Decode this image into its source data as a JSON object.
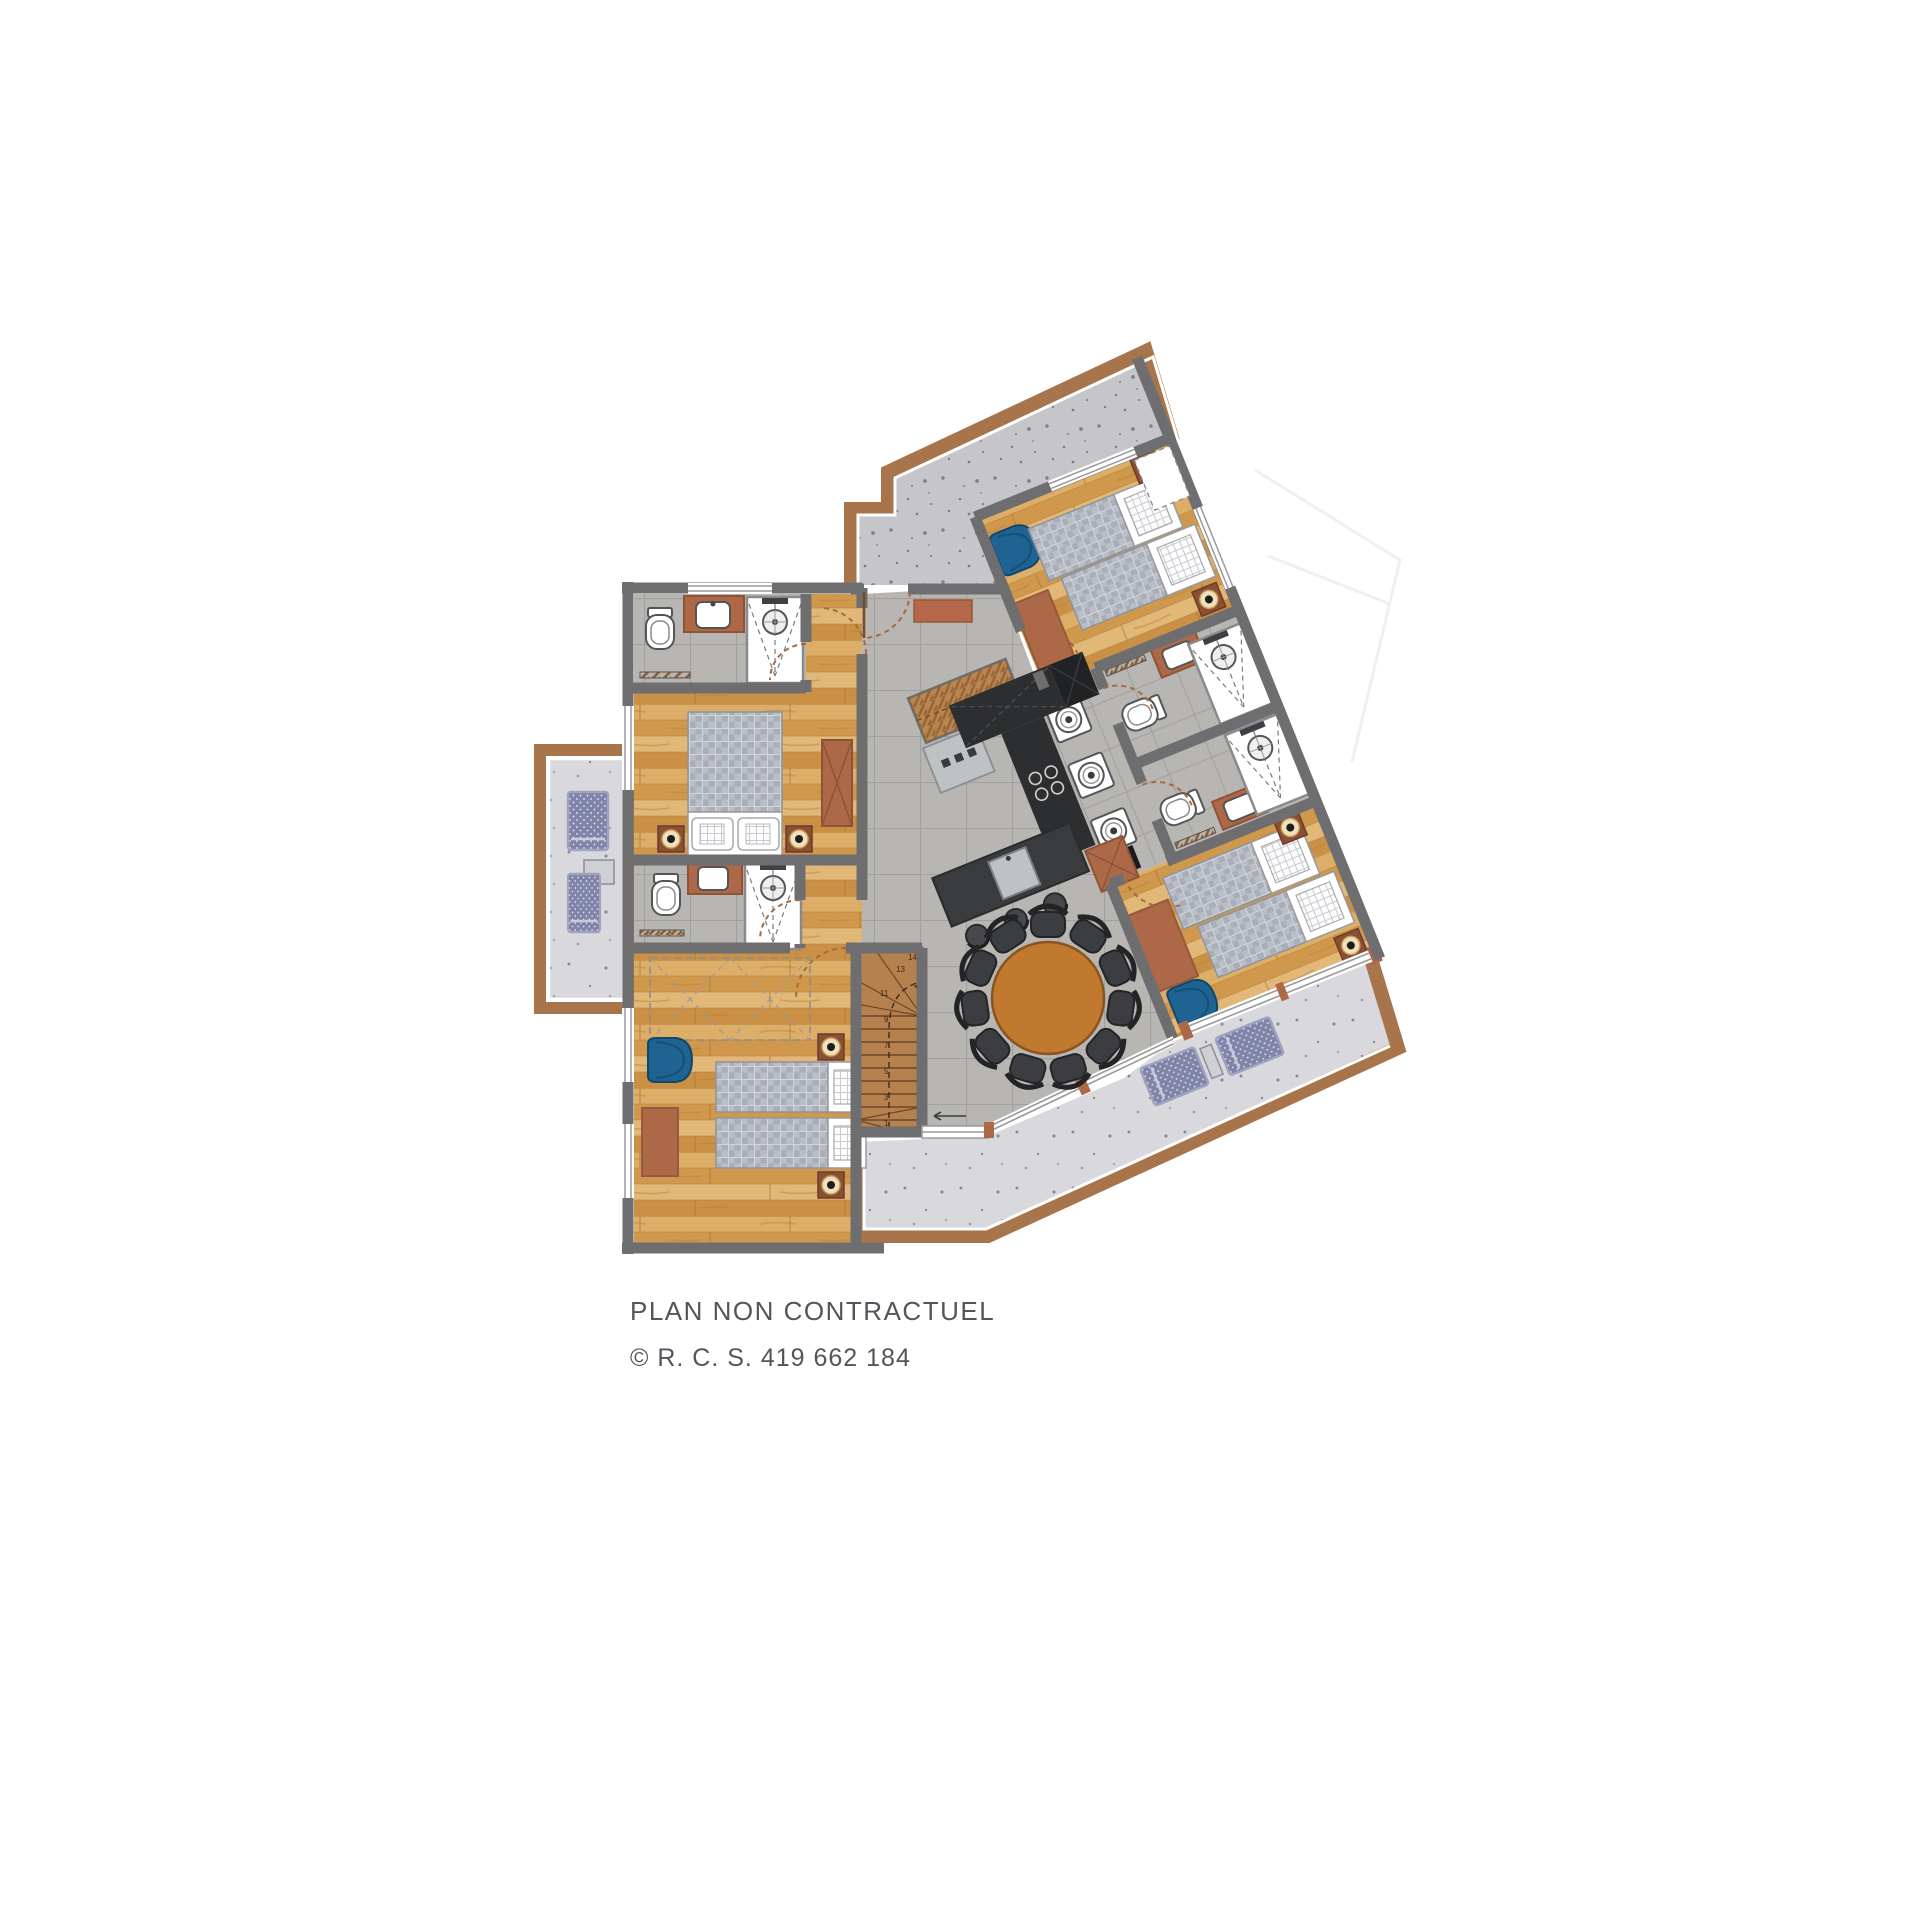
{
  "footer": {
    "disclaimer": "PLAN NON CONTRACTUEL",
    "registration": "© R. C. S. 419 662 184"
  },
  "stairs": {
    "steps": [
      "1",
      "2",
      "3",
      "4",
      "5",
      "6",
      "7",
      "8",
      "9",
      "10",
      "11",
      "12",
      "13",
      "14"
    ]
  },
  "plan": {
    "rotation_deg": -22,
    "rooms": [
      "terrace-top",
      "terrace-left",
      "terrace-bottom",
      "entry-hall",
      "dining-area",
      "kitchen",
      "bedroom-top-left",
      "bathroom-top-left",
      "bedroom-bottom-left",
      "bathroom-mid-left",
      "bedroom-top-right",
      "bathroom-right-upper",
      "bathroom-right-lower",
      "bedroom-right",
      "laundry",
      "stairs"
    ]
  },
  "palette": {
    "white": "#ffffff",
    "text": "#53555b",
    "wall": "#6e6e70",
    "tile": "#b8b6b2",
    "terrace-top": "#c6c6ca",
    "terrace-bottom": "#d9d9dd",
    "deck-border": "#a8744b",
    "terracotta": "#ad6847",
    "blue": "#1f6392",
    "blanket": "#a9aeb8",
    "cream": "#f0e1bd",
    "lamp-base": "#8a4f35",
    "counter": "#2d2e30",
    "island": "#3a3b3d",
    "steel": "#bfc2c4",
    "table": "#c0792e",
    "chair": "#3b3d40",
    "stair": "#b5824f",
    "lounge": "#8084a8",
    "ghost": "#edeef1"
  }
}
